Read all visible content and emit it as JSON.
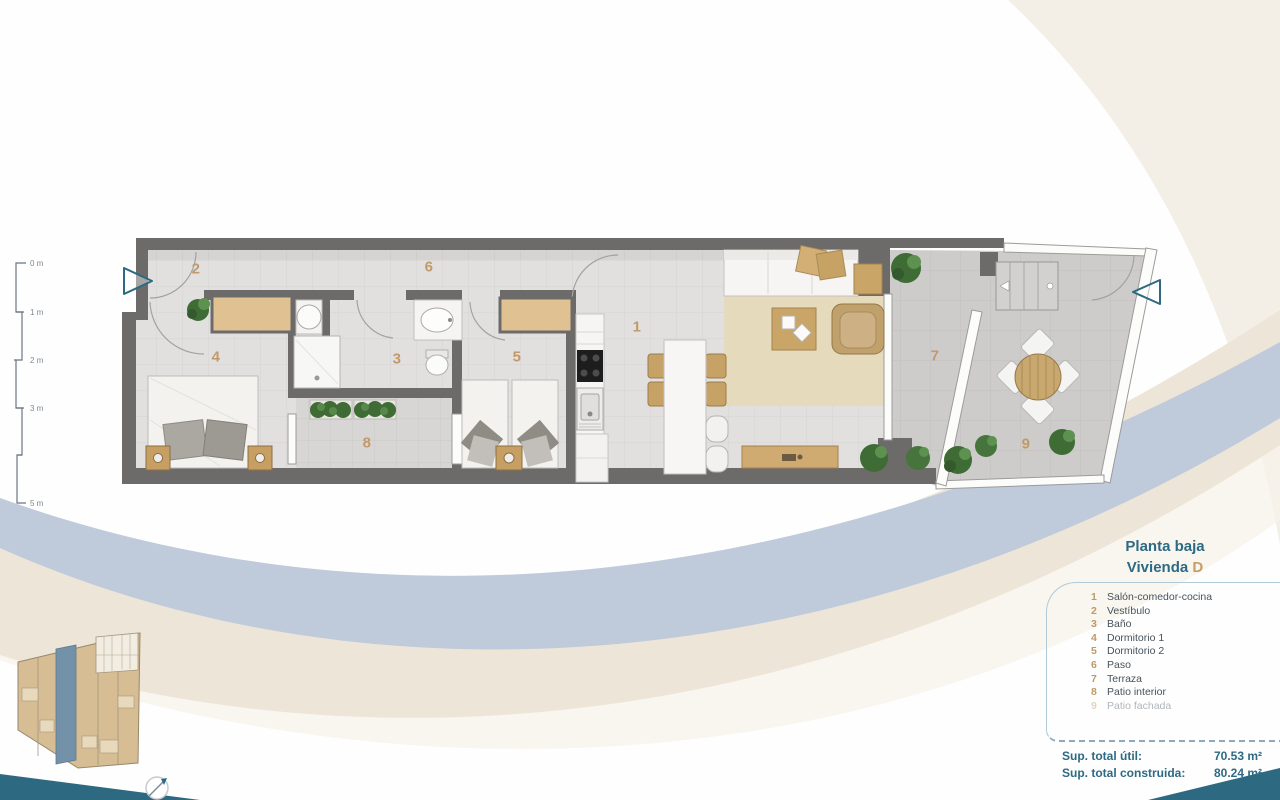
{
  "legend": {
    "title_line1": "Planta baja",
    "title_line2": "Vivienda",
    "unit_letter": "D",
    "items": [
      {
        "num": "1",
        "label": "Salón-comedor-cocina"
      },
      {
        "num": "2",
        "label": "Vestíbulo"
      },
      {
        "num": "3",
        "label": "Baño"
      },
      {
        "num": "4",
        "label": "Dormitorio 1"
      },
      {
        "num": "5",
        "label": "Dormitorio 2"
      },
      {
        "num": "6",
        "label": "Paso"
      },
      {
        "num": "7",
        "label": "Terraza"
      },
      {
        "num": "8",
        "label": "Patio interior"
      },
      {
        "num": "9",
        "label": "Patio fachada"
      }
    ],
    "totals": [
      {
        "label": "Sup. total útil:",
        "value": "70.53 m²"
      },
      {
        "label": "Sup. total construida:",
        "value": "80.24 m²"
      }
    ]
  },
  "plan": {
    "room_numbers": [
      "1",
      "2",
      "3",
      "4",
      "5",
      "6",
      "7",
      "8",
      "9"
    ]
  },
  "scale_ruler": {
    "ticks": [
      "0 m",
      "1 m",
      "2 m",
      "3 m",
      "5 m"
    ]
  },
  "colors": {
    "accent_teal": "#2d6a84",
    "accent_tan": "#c2996a",
    "wall_gray": "#6c6b6a",
    "swoosh_blue": "#bfcadb",
    "swoosh_beige": "#ece4d6"
  }
}
